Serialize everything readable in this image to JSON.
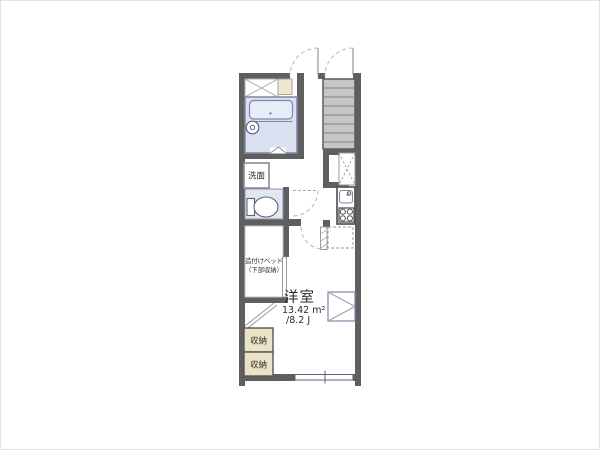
{
  "plan": {
    "room_label": "洋室",
    "room_area_sqm": "13.42 m²",
    "room_area_tatami": "/8.2 J",
    "washstand_label": "洗面",
    "storage_label_1": "収納",
    "storage_label_2": "収納",
    "bed_label_line1": "造付けベッド",
    "bed_label_line2": "（下部収納）",
    "colors": {
      "wall": "#5f5f5f",
      "stairs_fill": "#c6c6c6",
      "bath_fill": "#dce1f1",
      "toilet_room_fill": "#e2e6f1",
      "storage_fill": "#ebe3c8",
      "shelf_fill": "#eee8d3",
      "fixture_stroke": "#7d87a3"
    }
  }
}
